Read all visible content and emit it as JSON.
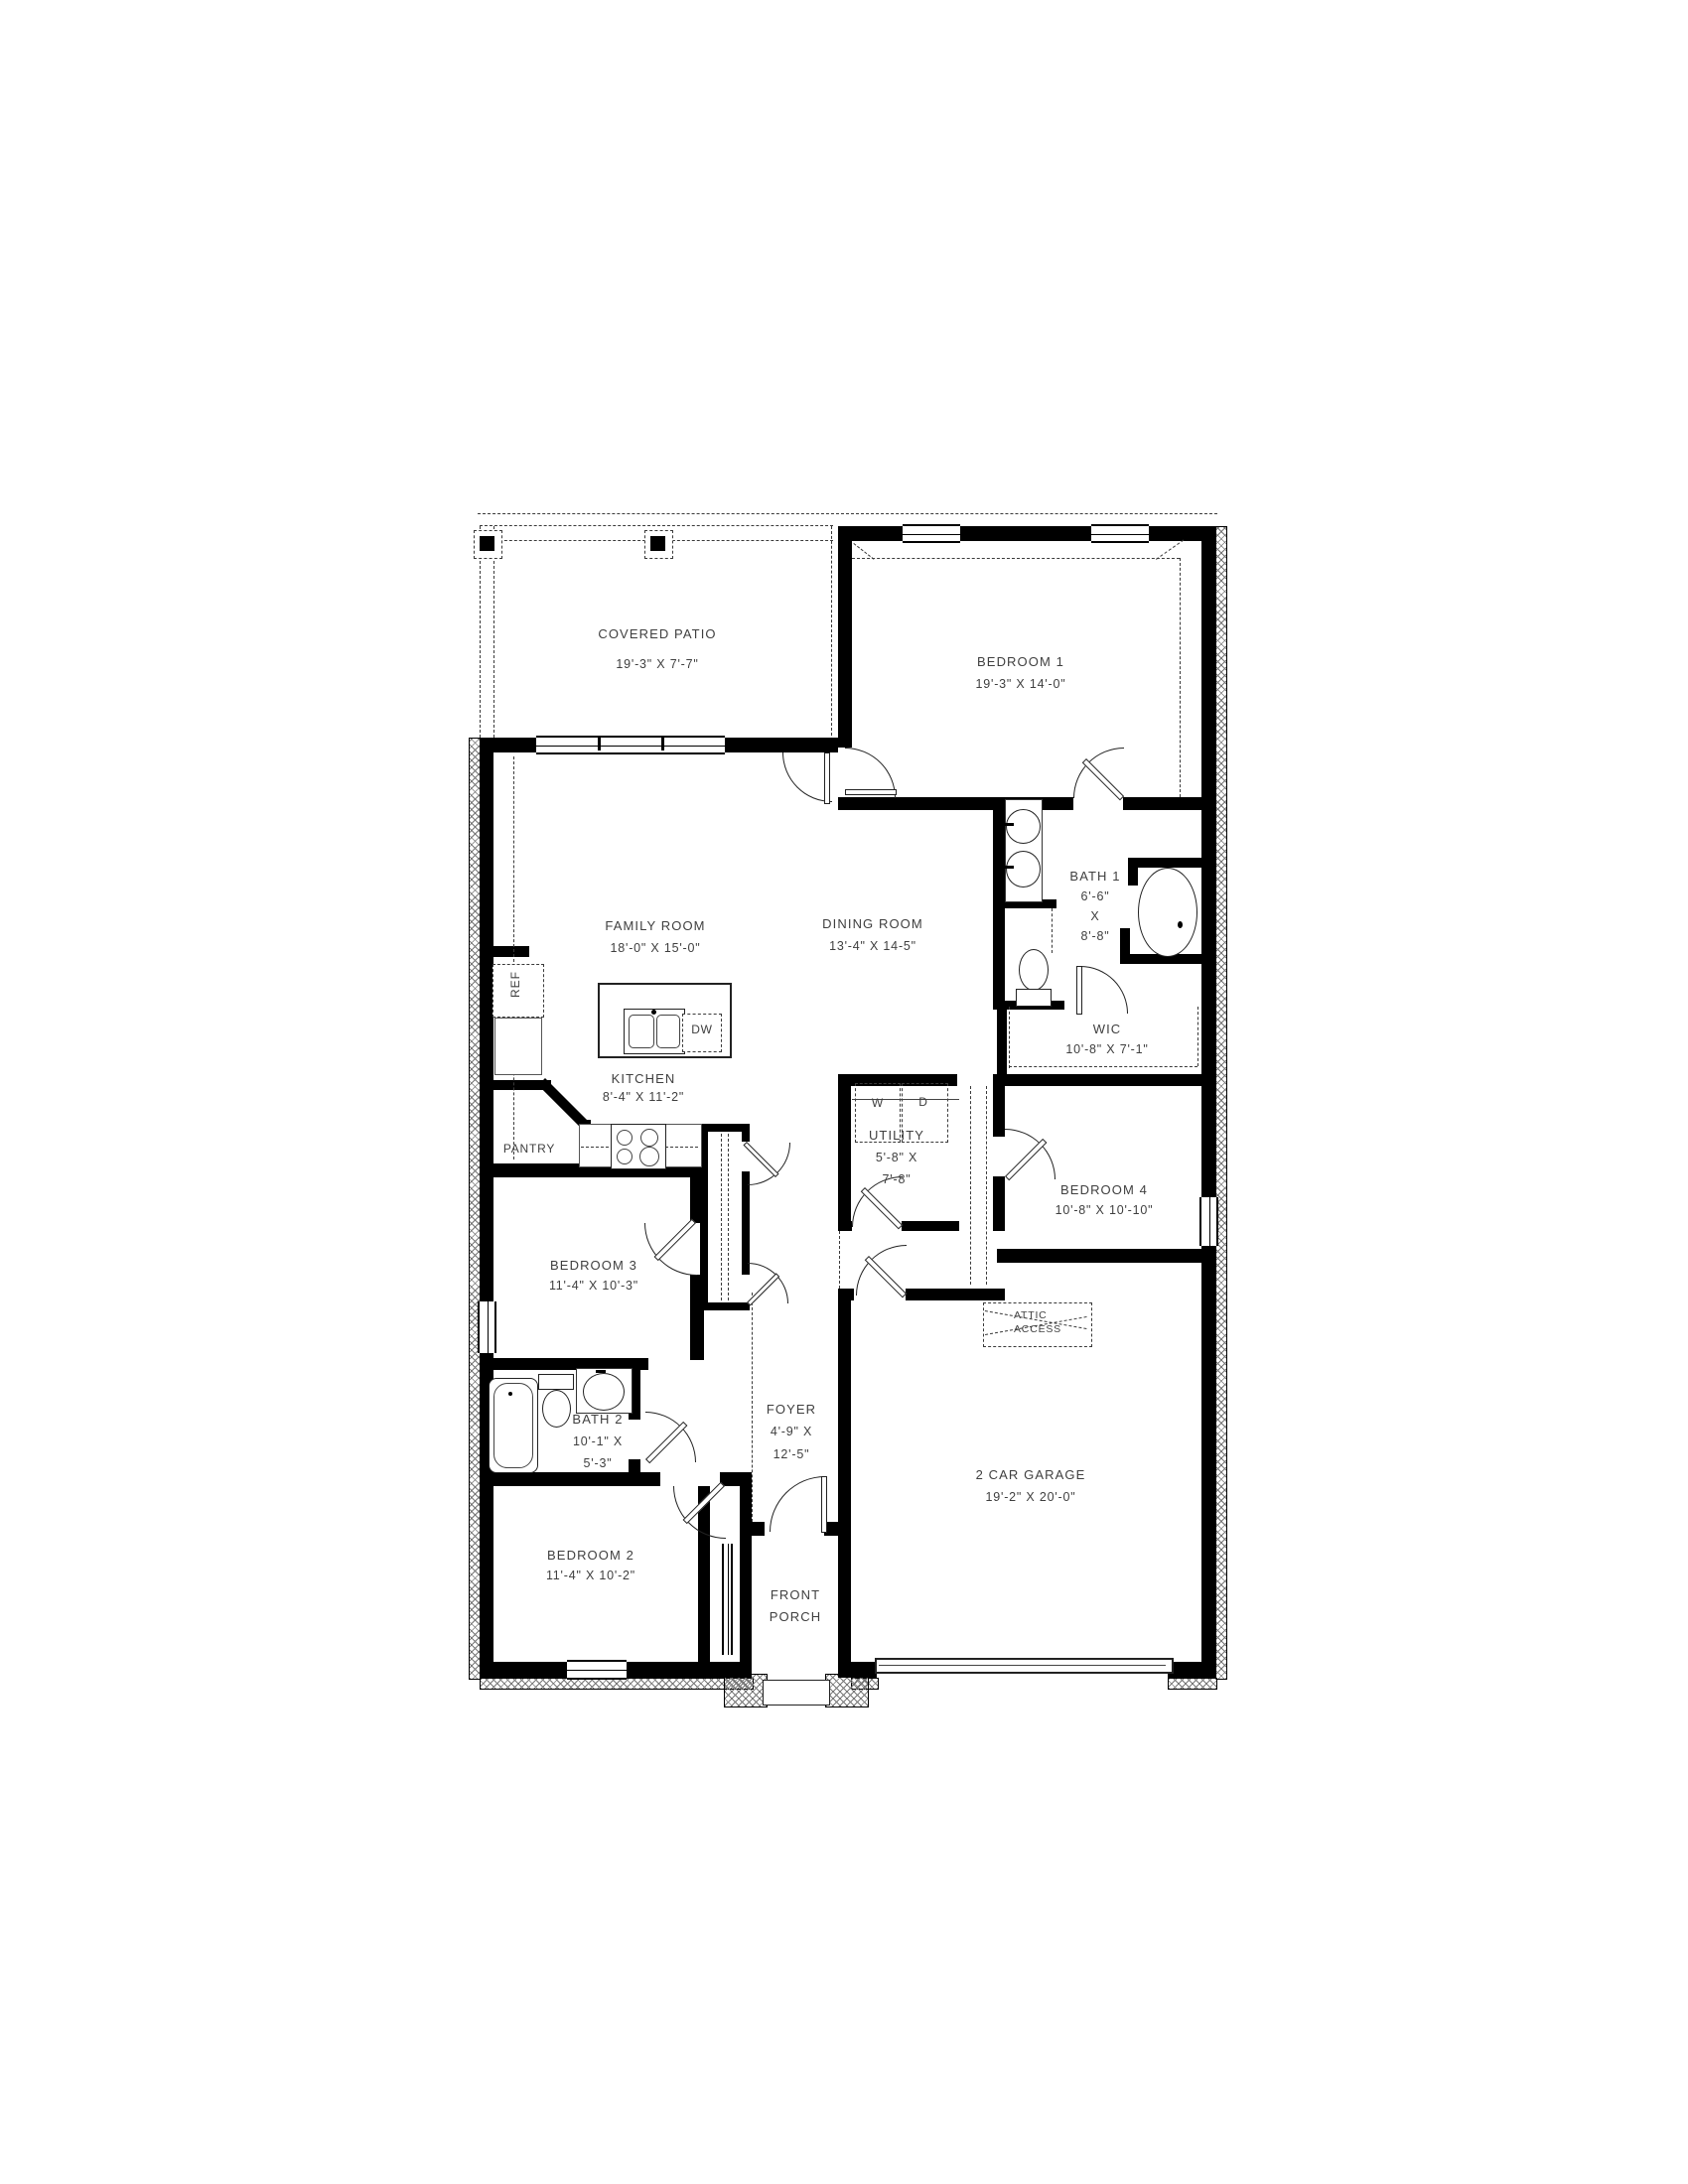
{
  "rooms": [
    {
      "id": "covered-patio",
      "label_lines": [
        "COVERED PATIO",
        "19'-3\" X 7'-7\""
      ]
    },
    {
      "id": "bedroom-1",
      "label_lines": [
        "BEDROOM 1",
        "19'-3\" X 14'-0\""
      ]
    },
    {
      "id": "family-room",
      "label_lines": [
        "FAMILY ROOM",
        "18'-0\" X 15'-0\""
      ]
    },
    {
      "id": "dining-room",
      "label_lines": [
        "DINING ROOM",
        "13'-4\" X 14-5\""
      ]
    },
    {
      "id": "bath-1",
      "label_lines": [
        "BATH 1",
        "6'-6\"",
        "X",
        "8'-8\""
      ]
    },
    {
      "id": "wic",
      "label_lines": [
        "WIC",
        "10'-8\" X 7'-1\""
      ]
    },
    {
      "id": "kitchen",
      "label_lines": [
        "KITCHEN",
        "8'-4\" X 11'-2\""
      ]
    },
    {
      "id": "utility",
      "label_lines": [
        "UTILITY",
        "5'-8\" X",
        "7'-8\""
      ]
    },
    {
      "id": "bedroom-4",
      "label_lines": [
        "BEDROOM 4",
        "10'-8\" X 10'-10\""
      ]
    },
    {
      "id": "garage",
      "label_lines": [
        "2 CAR GARAGE",
        "19'-2\" X 20'-0\""
      ]
    },
    {
      "id": "foyer",
      "label_lines": [
        "FOYER",
        "4'-9\" X",
        "12'-5\""
      ]
    },
    {
      "id": "bedroom-3",
      "label_lines": [
        "BEDROOM 3",
        "11'-4\" X 10'-3\""
      ]
    },
    {
      "id": "bath-2",
      "label_lines": [
        "BATH 2",
        "10'-1\" X",
        "5'-3\""
      ]
    },
    {
      "id": "bedroom-2",
      "label_lines": [
        "BEDROOM 2",
        "11'-4\" X 10'-2\""
      ]
    },
    {
      "id": "front-porch",
      "label_lines": [
        "FRONT",
        "PORCH"
      ]
    }
  ],
  "labels": {
    "pantry": "PANTRY",
    "ref": "REF",
    "dw": "DW",
    "washer": "W",
    "dryer": "D",
    "attic_line1": "ATTIC",
    "attic_line2": "ACCESS"
  },
  "colors": {
    "wall": "#000000",
    "text": "#3f3f3f",
    "line": "#222222"
  }
}
